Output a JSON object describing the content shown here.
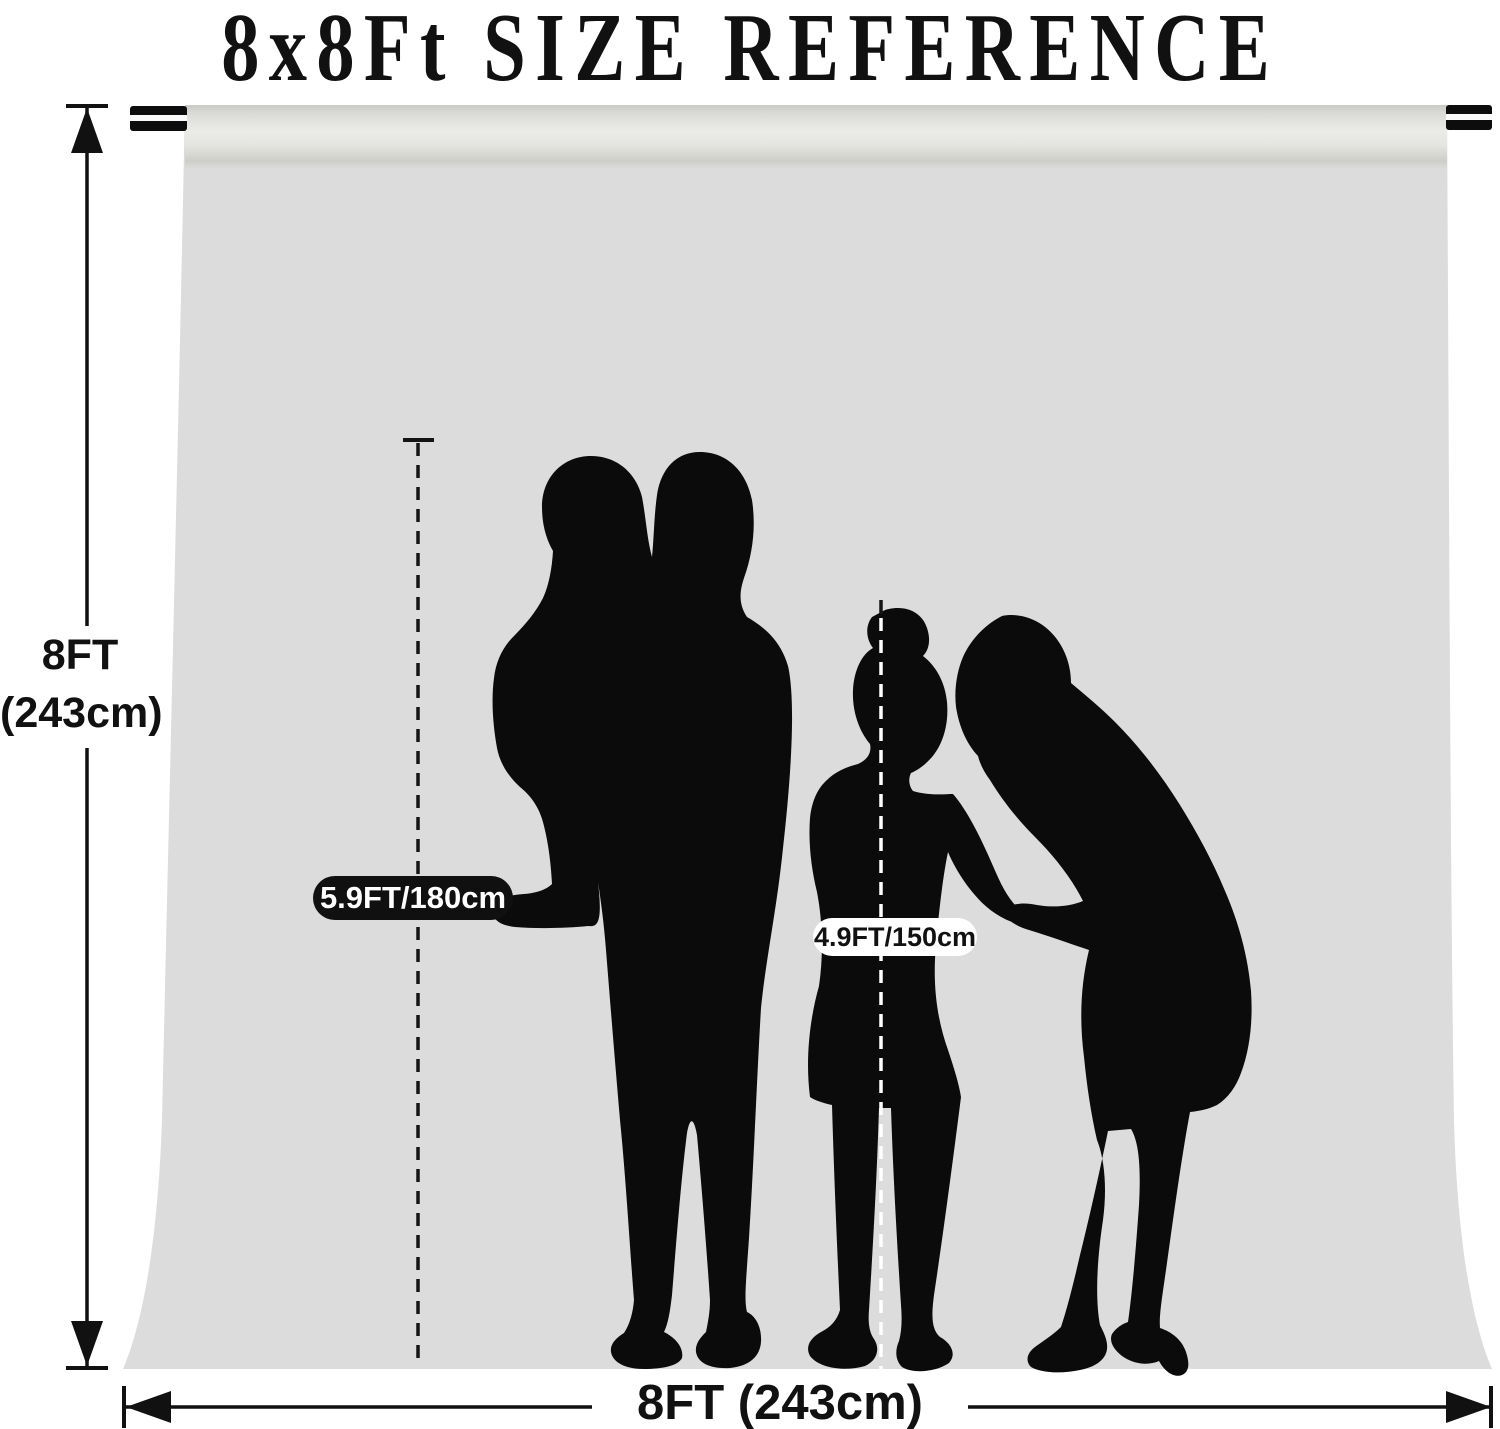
{
  "title": "8x8Ft SIZE REFERENCE",
  "labels": {
    "height_ft": "8FT",
    "height_cm": "(243cm)",
    "width": "8FT (243cm)",
    "adult_height": "5.9FT/180cm",
    "child_height": "4.9FT/150cm"
  },
  "colors": {
    "backdrop": "#dcdcdc",
    "silhouette": "#0b0b0b",
    "adult_pill_bg": "#101010",
    "adult_pill_text": "#ffffff",
    "child_pill_bg": "#ffffff",
    "child_pill_text": "#111111"
  }
}
